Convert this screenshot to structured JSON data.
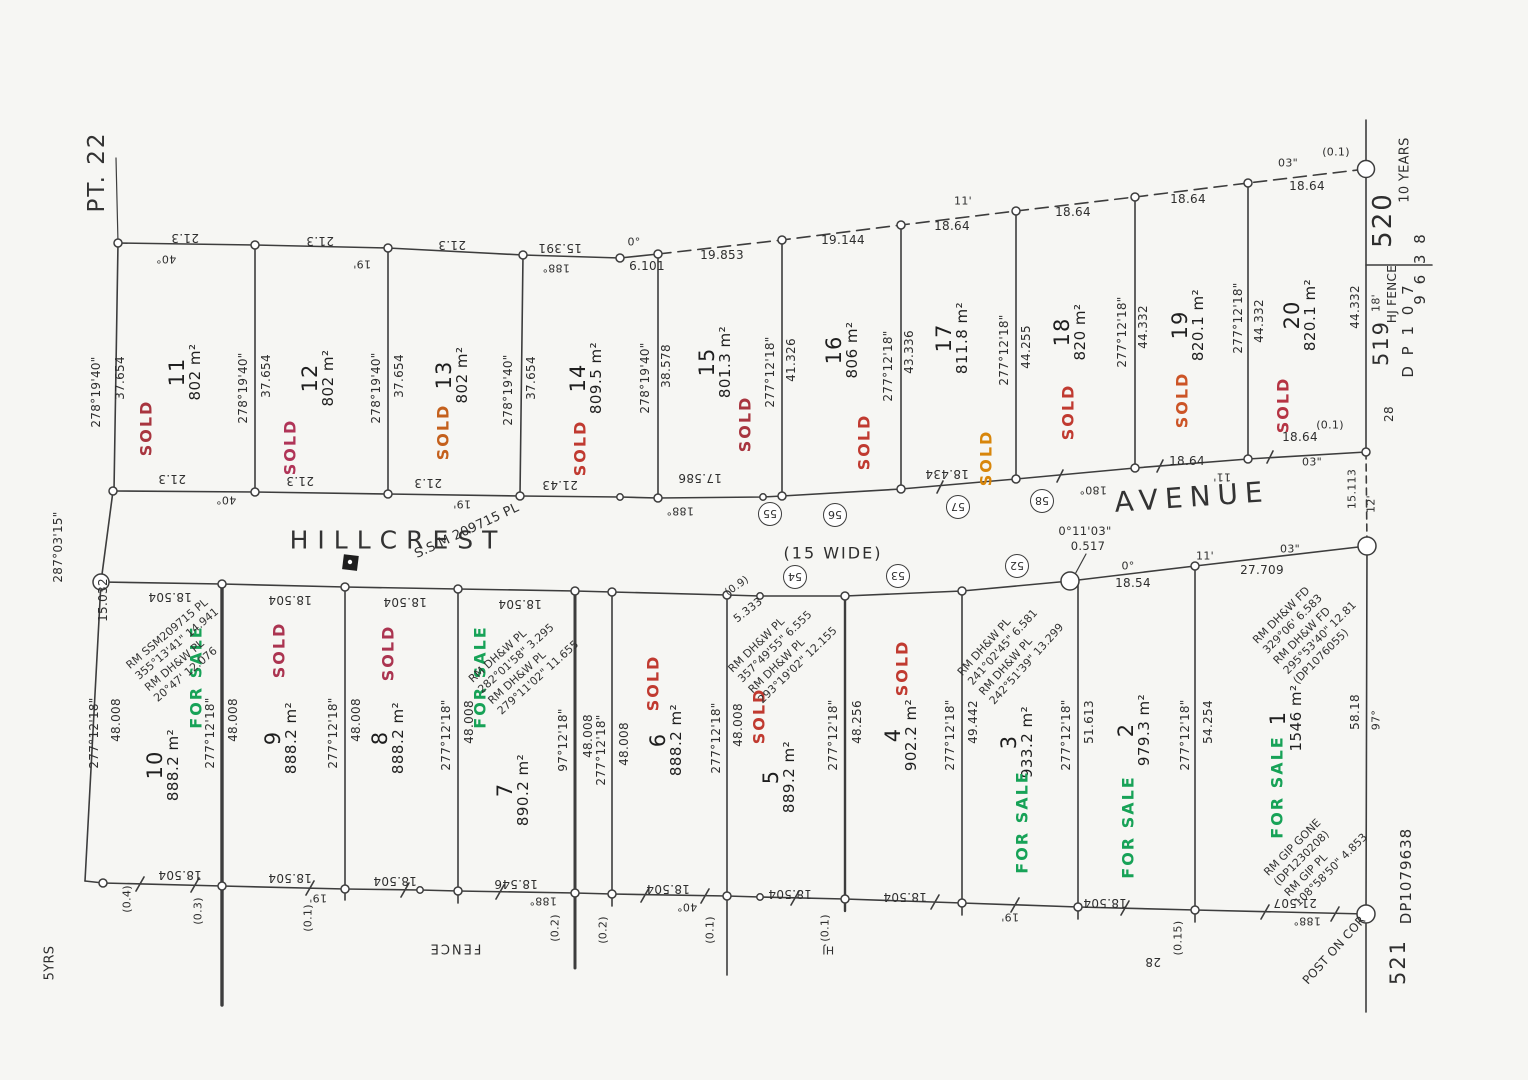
{
  "region_label": "PT. 22",
  "corner_year_note": "5YRS",
  "street": {
    "name_left": "HILLCREST",
    "width_note": "(15 WIDE)",
    "name_right": "AVENUE",
    "ssm": "S.S.M 209715 PL",
    "bend_bearing": "0°11'03\"",
    "bend_dist": "0.517"
  },
  "colors": {
    "sold_red": "#b83a38",
    "sold_crimson": "#aa3355",
    "sold_orange": "#d07c1e",
    "for_sale_green": "#17a257",
    "linework": "#3d3d3d"
  },
  "top_lots": [
    {
      "number": "11",
      "area": "802 m²",
      "status": "SOLD",
      "status_color": "#a8353f"
    },
    {
      "number": "12",
      "area": "802 m²",
      "status": "SOLD",
      "status_color": "#b03457"
    },
    {
      "number": "13",
      "area": "802 m²",
      "status": "SOLD",
      "status_color": "#c4601c"
    },
    {
      "number": "14",
      "area": "809.5 m²",
      "status": "SOLD",
      "status_color": "#c03a30"
    },
    {
      "number": "15",
      "area": "801.3 m²",
      "status": "SOLD",
      "status_color": "#a8353f"
    },
    {
      "number": "16",
      "area": "806 m²",
      "status": "SOLD",
      "status_color": "#c03a30"
    },
    {
      "number": "17",
      "area": "811.8 m²",
      "status": "SOLD",
      "status_color": "#d8860b"
    },
    {
      "number": "18",
      "area": "820 m²",
      "status": "SOLD",
      "status_color": "#c03a30"
    },
    {
      "number": "19",
      "area": "820.1 m²",
      "status": "SOLD",
      "status_color": "#cc5426"
    },
    {
      "number": "20",
      "area": "820.1 m²",
      "status": "SOLD",
      "status_color": "#b53443"
    }
  ],
  "bottom_lots": [
    {
      "number": "10",
      "area": "888.2 m²",
      "status": "FOR SALE",
      "status_color": "#17a257"
    },
    {
      "number": "9",
      "area": "888.2 m²",
      "status": "SOLD",
      "status_color": "#ab3450"
    },
    {
      "number": "8",
      "area": "888.2 m²",
      "status": "SOLD",
      "status_color": "#ab3450"
    },
    {
      "number": "7",
      "area": "890.2 m²",
      "status": "FOR SALE",
      "status_color": "#17a257"
    },
    {
      "number": "6",
      "area": "888.2 m²",
      "status": "SOLD",
      "status_color": "#c03a30"
    },
    {
      "number": "5",
      "area": "889.2 m²",
      "status": "SOLD",
      "status_color": "#c03a30"
    },
    {
      "number": "4",
      "area": "902.2 m²",
      "status": "SOLD",
      "status_color": "#c03a30"
    },
    {
      "number": "3",
      "area": "933.2 m²",
      "status": "FOR SALE",
      "status_color": "#17a257"
    },
    {
      "number": "2",
      "area": "979.3 m²",
      "status": "FOR SALE",
      "status_color": "#17a257"
    },
    {
      "number": "1",
      "area": "1546 m²",
      "status": "FOR SALE",
      "status_color": "#17a257"
    }
  ],
  "top_boundaries": [
    {
      "bearing": "278°19'40\"",
      "distance": "37.654"
    },
    {
      "bearing": "278°19'40\"",
      "distance": "37.654"
    },
    {
      "bearing": "278°19'40\"",
      "distance": "37.654"
    },
    {
      "bearing": "278°19'40\"",
      "distance": "37.654"
    },
    {
      "bearing": "278°19'40\"",
      "distance": "38.578"
    },
    {
      "bearing": "277°12'18\"",
      "distance": "41.326"
    },
    {
      "bearing": "277°12'18\"",
      "distance": "43.336"
    },
    {
      "bearing": "277°12'18\"",
      "distance": "44.255"
    },
    {
      "bearing": "277°12'18\"",
      "distance": "44.332"
    },
    {
      "bearing": "277°12'18\"",
      "distance": "44.332"
    },
    {
      "bearing": "18'",
      "distance": "44.332"
    }
  ],
  "bottom_boundaries": [
    {
      "bearing": "277°12'18\"",
      "distance": "48.008"
    },
    {
      "bearing": "277°12'18\"",
      "distance": "48.008"
    },
    {
      "bearing": "277°12'18\"",
      "distance": "48.008"
    },
    {
      "bearing": "277°12'18\"",
      "distance": "48.008"
    },
    {
      "bearing": "97°12'18\"",
      "distance": "48.008"
    },
    {
      "bearing": "277°12'18\"",
      "distance": "48.008"
    },
    {
      "bearing": "277°12'18\"",
      "distance": "48.008"
    },
    {
      "bearing": "277°12'18\"",
      "distance": "48.256"
    },
    {
      "bearing": "277°12'18\"",
      "distance": "49.442"
    },
    {
      "bearing": "277°12'18\"",
      "distance": "51.613"
    },
    {
      "bearing": "277°12'18\"",
      "distance": "54.254"
    },
    {
      "bearing": "97°",
      "distance": "58.18"
    }
  ],
  "west_boundary": {
    "bearing": "287°03'15\"",
    "distance": "15.032"
  },
  "edge_labels": {
    "top": [
      "21.3",
      "40°",
      "21.3",
      "19'",
      "21.3",
      "15.391",
      "188°",
      "0°",
      "6.101",
      "19.853",
      "19.144",
      "11'",
      "18.64",
      "18.64",
      "18.64",
      "18.64",
      "03\"",
      "(0.1)"
    ],
    "street_north": [
      "21.3",
      "40°",
      "21.3",
      "21.3",
      "19'",
      "21.43",
      "188°",
      "17.586",
      "18.434",
      "180°",
      "18.64",
      "11'",
      "18.64",
      "03\"",
      "(0.1)"
    ],
    "street_south": [
      "18.504",
      "18.504",
      "18.504",
      "18.504",
      "(0.9)",
      "5.333",
      "0°",
      "18.54",
      "11'",
      "27.709",
      "03\""
    ],
    "fence": [
      "18.504",
      "(0.4)",
      "(0.3)",
      "18.504",
      "19'",
      "(0.1)",
      "18.504",
      "188°",
      "(0.2)",
      "18.546",
      "(0.2)",
      "18.504",
      "40°",
      "(0.1)",
      "18.504",
      "(0.1)",
      "HJ",
      "18.504",
      "19'",
      "18.504",
      "(0.15)",
      "28",
      "21.507",
      "188°"
    ],
    "fence_word": "FENCE"
  },
  "street_marks": {
    "north": [
      "55",
      "56",
      "57",
      "58"
    ],
    "south": [
      "54",
      "53",
      "52"
    ]
  },
  "rm_notes": [
    {
      "lines": [
        "RM SSM209715 PL",
        "355°13'41\"  14.941",
        "RM DH&W PL",
        "20°47'  12.076"
      ]
    },
    {
      "lines": [
        "RM DH&W PL",
        "282°01'58\"  3.295",
        "RM DH&W PL",
        "279°11'02\"  11.655"
      ]
    },
    {
      "lines": [
        "RM DH&W PL",
        "357°49'55\"  6.555",
        "RM DH&W PL",
        "293°19'02\"  12.155"
      ]
    },
    {
      "lines": [
        "RM DH&W PL",
        "241°02'45\"  6.581",
        "RM DH&W PL",
        "242°51'39\"  13.299"
      ]
    },
    {
      "lines": [
        "RM DH&W FD",
        "329°06'  6.583",
        "RM DH&W FD",
        "295°53'40\"  12.81",
        "(DP1076055)"
      ]
    },
    {
      "lines": [
        "RM GIP GONE",
        "(DP1230208)",
        "RM GIP PL",
        "108°58'50\"  4.853"
      ]
    }
  ],
  "right_margin": {
    "lot_520": "520",
    "years_note": "10 YEARS",
    "dp_digits": "9 6 3 8",
    "dp_label": "D P 1 0 7",
    "lot_519": "519",
    "fence_note": "HJ FENCE",
    "mark_28": "28",
    "lot_521": "521",
    "dp_bottom": "DP1079638",
    "gap_dist": "15.113",
    "gap_min": "12'",
    "corner_note": "POST ON COR"
  }
}
